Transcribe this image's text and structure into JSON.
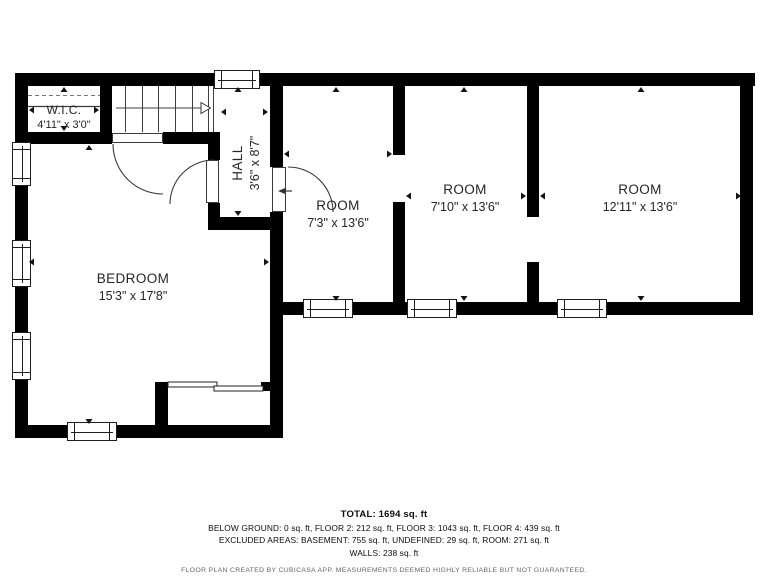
{
  "plan": {
    "rooms": [
      {
        "name": "W.I.C.",
        "dims": "4'11\" x 3'0\""
      },
      {
        "name": "HALL",
        "dims": "3'6\" x 8'7\""
      },
      {
        "name": "BEDROOM",
        "dims": "15'3\" x 17'8\""
      },
      {
        "name": "ROOM",
        "dims": "7'3\" x 13'6\""
      },
      {
        "name": "ROOM",
        "dims": "7'10\" x 13'6\""
      },
      {
        "name": "ROOM",
        "dims": "12'11\" x 13'6\""
      }
    ],
    "colors": {
      "walls": "#000000",
      "background": "#ffffff",
      "label_text": "#262626",
      "disclaimer_text": "#6b655b"
    }
  },
  "footer": {
    "total": "TOTAL: 1694 sq. ft",
    "floors": "BELOW GROUND: 0 sq. ft, FLOOR 2: 212 sq. ft, FLOOR 3: 1043 sq. ft, FLOOR 4: 439 sq. ft",
    "excluded": "EXCLUDED AREAS: BASEMENT: 755 sq. ft, UNDEFINED: 29 sq. ft, ROOM: 271 sq. ft",
    "walls": "WALLS: 238 sq. ft",
    "disclaimer": "FLOOR PLAN CREATED BY CUBICASA APP. MEASUREMENTS DEEMED HIGHLY RELIABLE BUT NOT GUARANTEED."
  }
}
